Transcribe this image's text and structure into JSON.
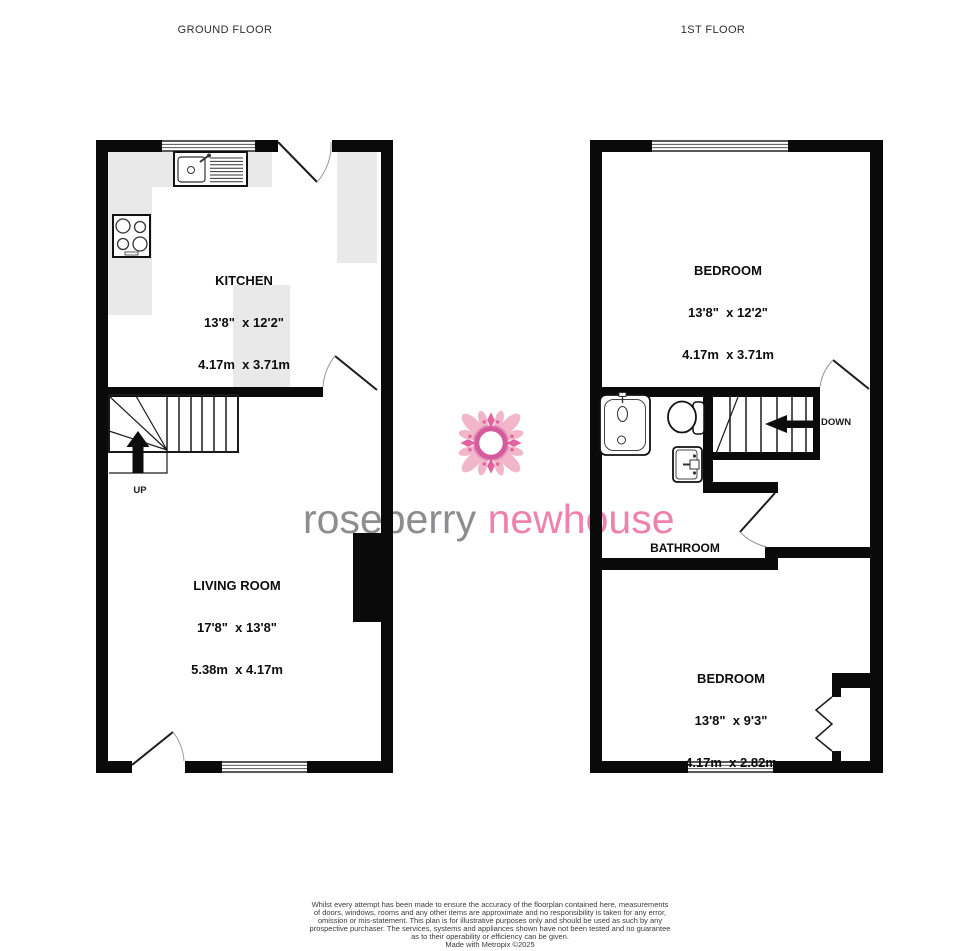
{
  "titles": {
    "ground_floor": "GROUND FLOOR",
    "first_floor": "1ST FLOOR"
  },
  "ground_floor": {
    "kitchen": {
      "name": "KITCHEN",
      "imperial": "13'8\"  x 12'2\"",
      "metric": "4.17m  x 3.71m"
    },
    "living_room": {
      "name": "LIVING ROOM",
      "imperial": "17'8\"  x 13'8\"",
      "metric": "5.38m  x 4.17m"
    },
    "stairs_label": "UP"
  },
  "first_floor": {
    "bedroom_front": {
      "name": "BEDROOM",
      "imperial": "13'8\"  x 12'2\"",
      "metric": "4.17m  x 3.71m"
    },
    "bathroom": {
      "name": "BATHROOM"
    },
    "bedroom_back": {
      "name": "BEDROOM",
      "imperial": "13'8\"  x 9'3\"",
      "metric": "4.17m  x 2.82m"
    },
    "stairs_label": "DOWN"
  },
  "watermark": {
    "brand_word_gray": "roseberry",
    "brand_word_pink": "newhouse"
  },
  "footer": {
    "lines": [
      "Whilst every attempt has been made to ensure the accuracy of the floorplan contained here, measurements",
      "of doors, windows, rooms and any other items are approximate and no responsibility is taken for any error,",
      "omission or mis-statement. This plan is for illustrative purposes only and should be used as such by any",
      "prospective purchaser. The services, systems and appliances shown have not been tested and no guarantee",
      "as to their operability or efficiency can be given.",
      "Made with Metropix ©2025"
    ]
  },
  "colors": {
    "wall": "#0a0a0a",
    "counter": "#e9e9e9",
    "watermark_gray": "#8d8d90",
    "watermark_pink": "#ee82ad",
    "flower_light": "#f2b6ca",
    "flower_dark": "#d55c9c"
  }
}
